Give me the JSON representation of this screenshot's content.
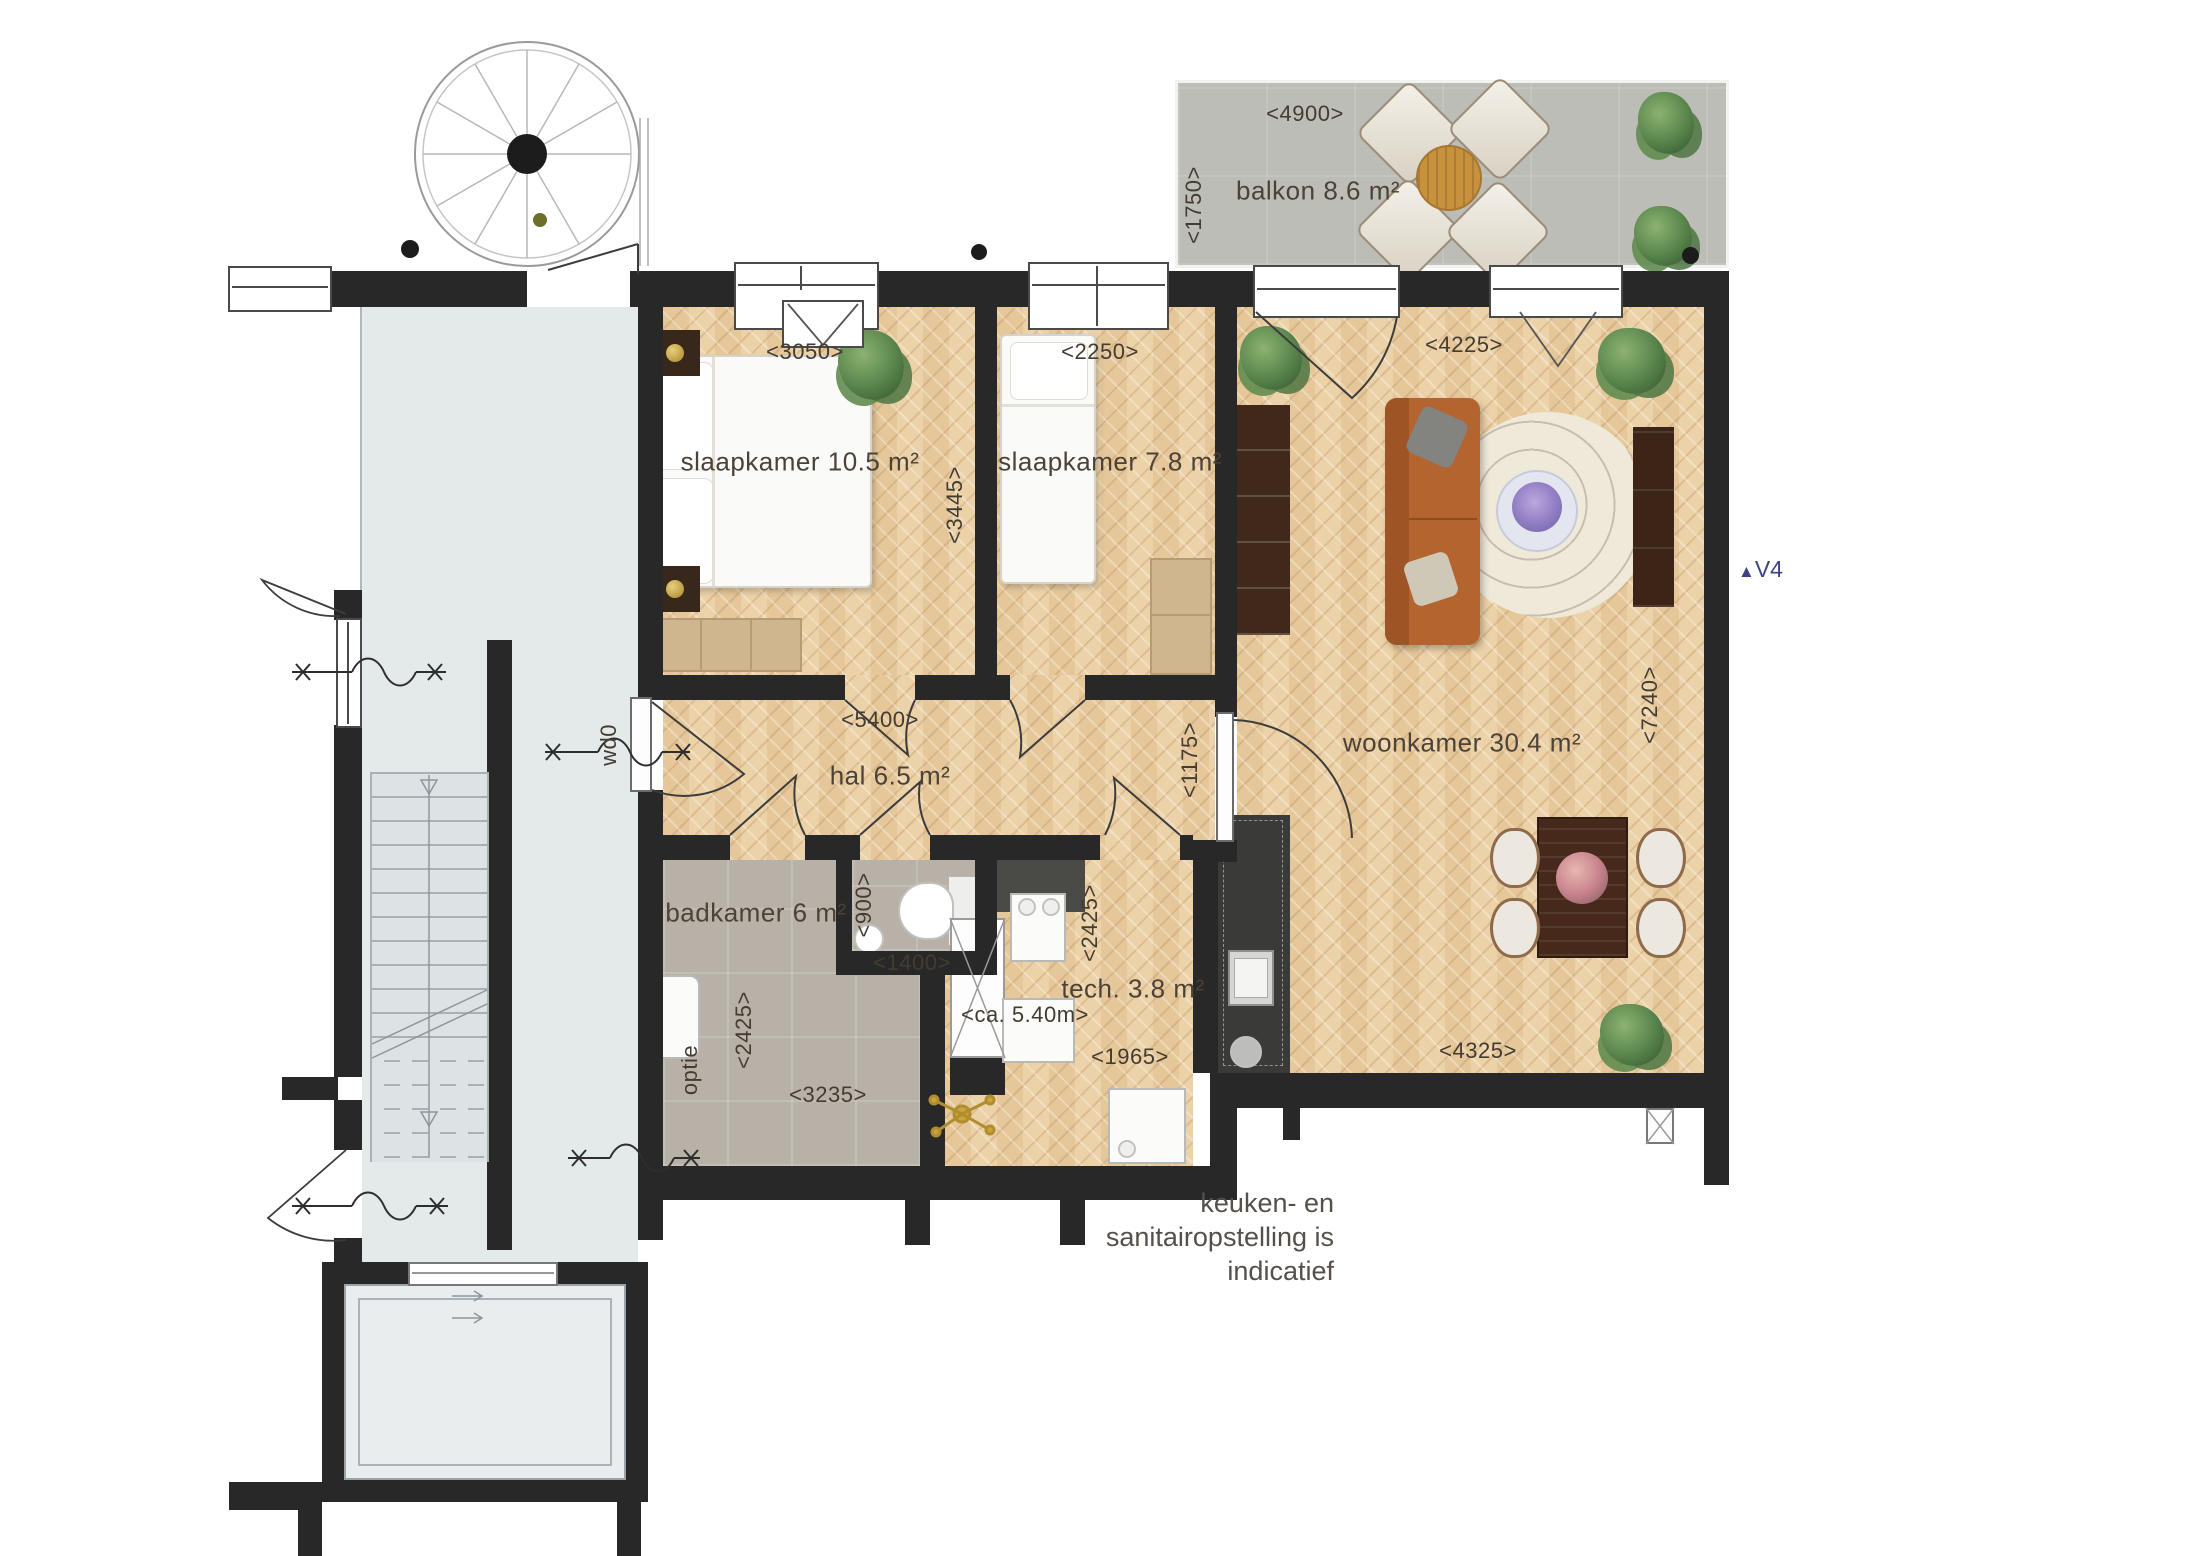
{
  "plan": {
    "type": "apartment-floor-plan",
    "rooms": {
      "balkon": {
        "label": "balkon 8.6 m²",
        "width_dim": "<4900>",
        "depth_dim": "<1750>"
      },
      "slaapkamer1": {
        "label": "slaapkamer 10.5 m²",
        "width_dim": "<3050>",
        "height_dim": "<3445>"
      },
      "slaapkamer2": {
        "label": "slaapkamer 7.8 m²",
        "width_dim": "<2250>"
      },
      "woonkamer": {
        "label": "woonkamer 30.4 m²",
        "top_dim": "<4225>",
        "right_dim": "<7240>",
        "bottom_dim": "<4325>"
      },
      "hal": {
        "label": "hal 6.5 m²",
        "width_dim": "<5400>",
        "door_dim": "<1175>"
      },
      "badkamer": {
        "label": "badkamer 6 m²",
        "depth_dim": "<2425>",
        "width_dim": "<3235>",
        "option_label": "optie"
      },
      "toilet": {
        "depth_dim": "<900>",
        "width_dim": "<1400>"
      },
      "techniek": {
        "label": "tech. 3.8 m²",
        "depth_dim": "<2425>",
        "width_dim": "<1965>",
        "length_note": "<ca. 5.40m>"
      }
    },
    "annotations": {
      "entrance_door": "wd0",
      "view_marker": "V4",
      "caption_line1": "keuken- en sanitairopstelling is",
      "caption_line2": "indicatief"
    },
    "colors": {
      "wall": "#282828",
      "wood_floor": "#ecd2a8",
      "bathroom_floor": "#b7b1a7",
      "balcony_floor": "#bdbdb8",
      "stairwell_floor": "#e4e9ea",
      "kitchen_block": "#3a3a38",
      "accent_marker": "#3d4285"
    }
  }
}
